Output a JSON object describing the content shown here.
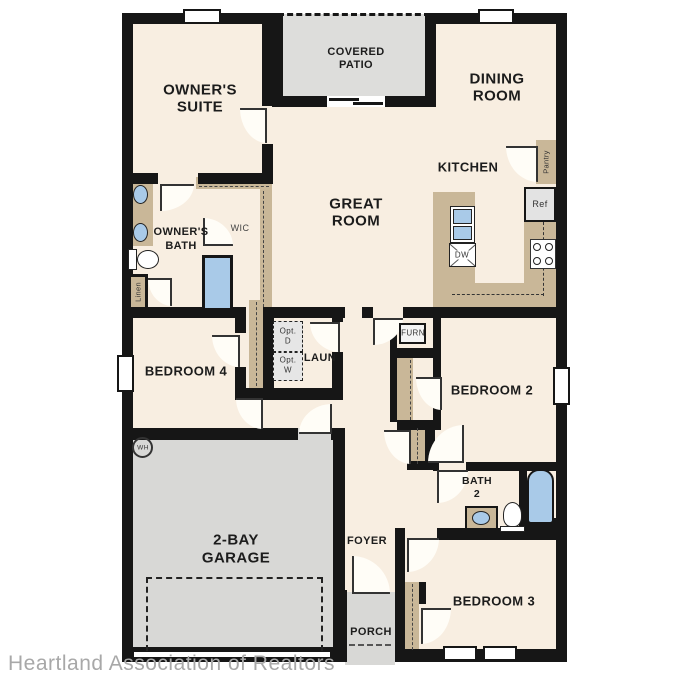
{
  "document": "single-story-house-floor-plan",
  "watermark": "Heartland Association of Realtors",
  "colors": {
    "floor": "#f8eee1",
    "walls": "#161616",
    "cabinetry_tan": "#c9b798",
    "garage_patio_gray": "#d8d8d6",
    "plumbing_blue": "#a9cae8",
    "watermark_gray": "#a8a8a8"
  },
  "labels": {
    "owners_suite": [
      "OWNER'S",
      "SUITE"
    ],
    "covered_patio": [
      "COVERED",
      "PATIO"
    ],
    "dining_room": [
      "DINING",
      "ROOM"
    ],
    "kitchen": "KITCHEN",
    "great_room": [
      "GREAT",
      "ROOM"
    ],
    "owners_bath": [
      "OWNER'S",
      "BATH"
    ],
    "wic": "WIC",
    "linen": "Linen",
    "pantry": "Pantry",
    "ref": "Ref",
    "dw": "DW",
    "furn": "FURN",
    "bedroom2": "BEDROOM 2",
    "bedroom3": "BEDROOM 3",
    "bedroom4": "BEDROOM 4",
    "laundry": "LAUN",
    "opt_dryer": [
      "Opt.",
      "D"
    ],
    "opt_washer": [
      "Opt.",
      "W"
    ],
    "garage": [
      "2-BAY",
      "GARAGE"
    ],
    "foyer": "FOYER",
    "porch": "PORCH",
    "bath2": [
      "BATH",
      "2"
    ],
    "water_heater": "WH"
  }
}
